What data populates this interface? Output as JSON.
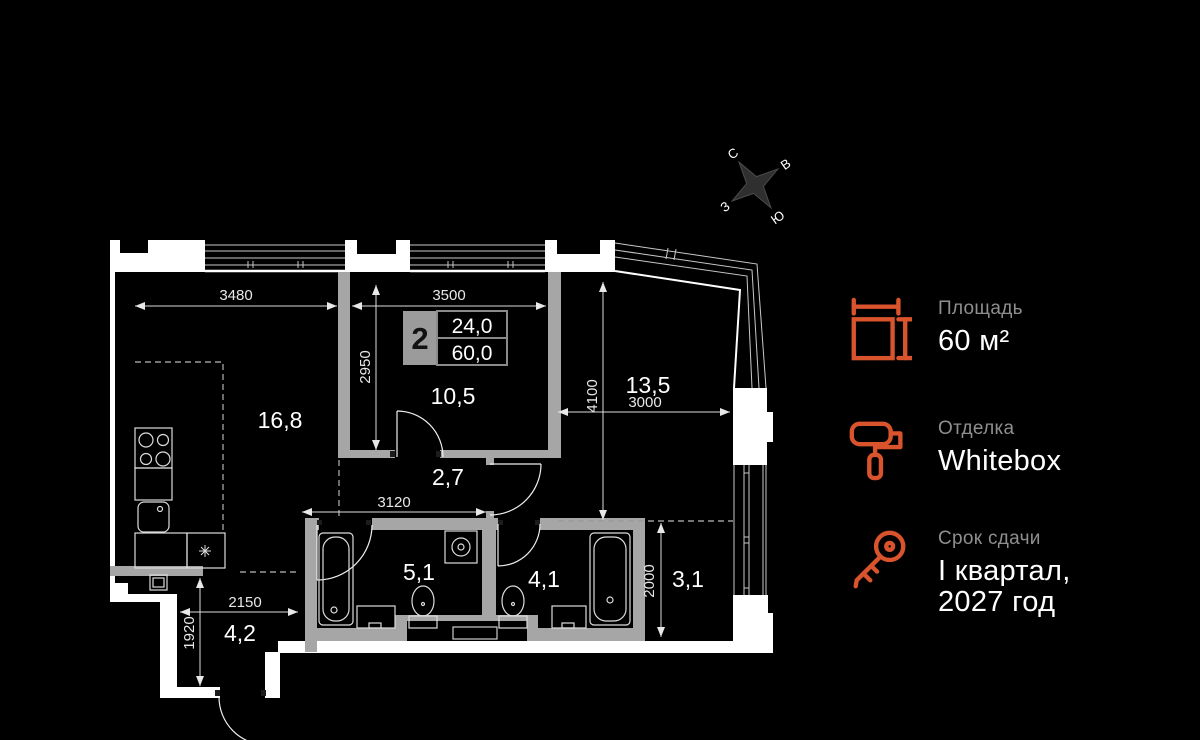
{
  "compass": {
    "n": "С",
    "e": "В",
    "s": "Ю",
    "w": "З"
  },
  "plan": {
    "badge": {
      "rooms": "2",
      "area_living": "24,0",
      "area_total": "60,0"
    },
    "rooms": {
      "living": "16,8",
      "bedroom": "10,5",
      "hallway": "2,7",
      "kitchen_living": "13,5",
      "bathroom_1": "5,1",
      "bathroom_2": "4,1",
      "loggia": "3,1",
      "entry": "4,2"
    },
    "dims": {
      "top_left": "3480",
      "top_mid": "3500",
      "bedroom_depth": "2950",
      "right_depth": "4100",
      "right_width": "3000",
      "hallway_width": "3120",
      "entry_width": "2150",
      "entry_depth": "1920",
      "loggia_depth": "2000"
    }
  },
  "info_panel": {
    "area": {
      "label": "Площадь",
      "value": "60 м²"
    },
    "finishing": {
      "label": "Отделка",
      "value": "Whitebox"
    },
    "completion": {
      "label": "Срок сдачи",
      "line1": "I квартал,",
      "line2": "2027 год"
    }
  },
  "colors": {
    "accent": "#D9532C"
  }
}
